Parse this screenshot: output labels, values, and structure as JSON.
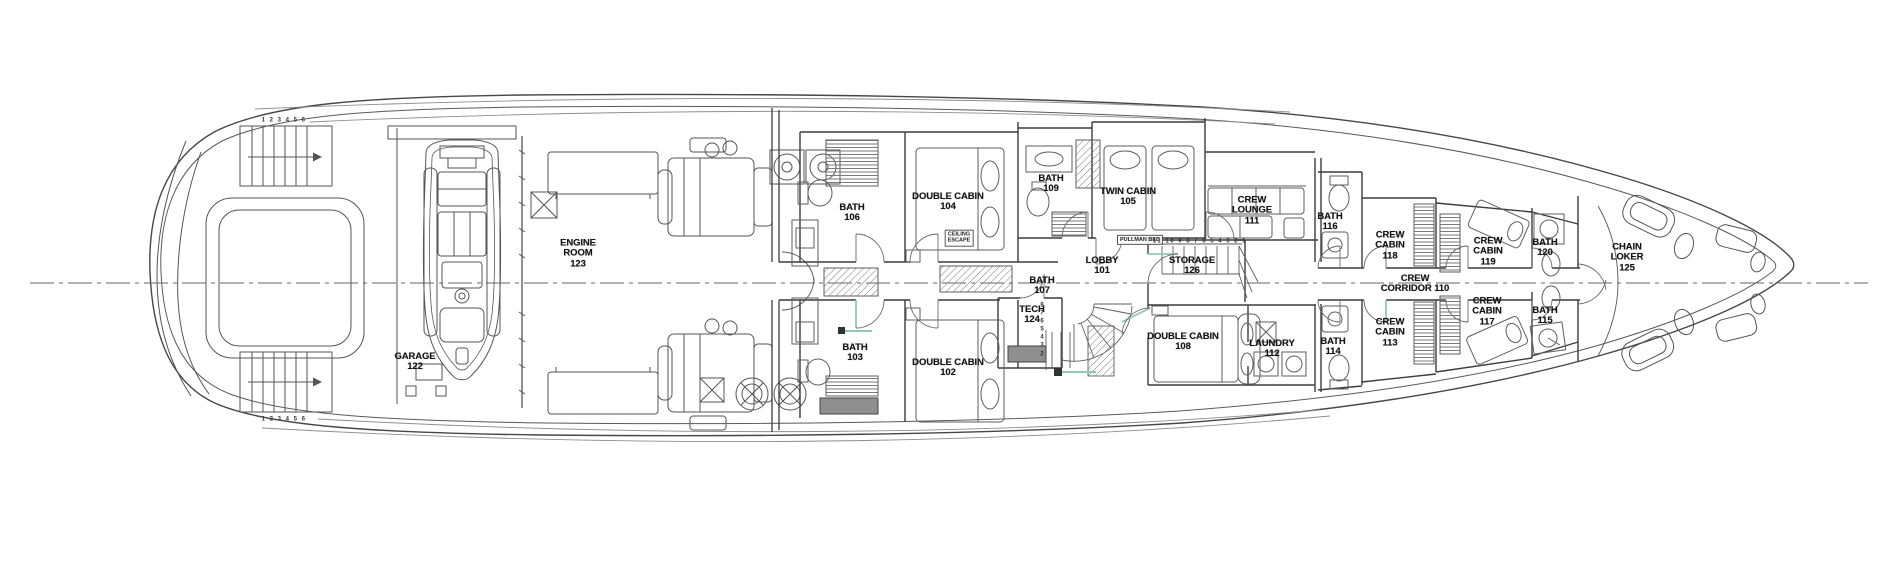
{
  "colors": {
    "paper": "#ffffff",
    "ink": "#4a4a4a",
    "wall_ink": "#3c3c3c",
    "label_ink": "#141414",
    "door_accent": "#8fc9ba",
    "solid_gray": "#8f8f8f"
  },
  "labels": {
    "rooms": [
      {
        "name": "garage",
        "lines": [
          "GARAGE",
          "122"
        ],
        "x": 415,
        "y": 362
      },
      {
        "name": "engine-room",
        "lines": [
          "ENGINE",
          "ROOM",
          "123"
        ],
        "x": 578,
        "y": 254
      },
      {
        "name": "bath-106",
        "lines": [
          "BATH",
          "106"
        ],
        "x": 852,
        "y": 213
      },
      {
        "name": "double-cabin-104",
        "lines": [
          "DOUBLE CABIN",
          "104"
        ],
        "x": 948,
        "y": 202
      },
      {
        "name": "bath-103",
        "lines": [
          "BATH",
          "103"
        ],
        "x": 855,
        "y": 353
      },
      {
        "name": "double-cabin-102",
        "lines": [
          "DOUBLE CABIN",
          "102"
        ],
        "x": 948,
        "y": 368
      },
      {
        "name": "bath-109",
        "lines": [
          "BATH",
          "109"
        ],
        "x": 1051,
        "y": 184
      },
      {
        "name": "twin-cabin-105",
        "lines": [
          "TWIN CABIN",
          "105"
        ],
        "x": 1128,
        "y": 197
      },
      {
        "name": "lobby-101",
        "lines": [
          "LOBBY",
          "101"
        ],
        "x": 1102,
        "y": 266
      },
      {
        "name": "bath-107",
        "lines": [
          "BATH",
          "107"
        ],
        "x": 1042,
        "y": 286
      },
      {
        "name": "tech-124",
        "lines": [
          "TECH",
          "124"
        ],
        "x": 1032,
        "y": 315
      },
      {
        "name": "storage-126",
        "lines": [
          "STORAGE",
          "126"
        ],
        "x": 1192,
        "y": 266
      },
      {
        "name": "crew-lounge-111",
        "lines": [
          "CREW",
          "LOUNGE",
          "111"
        ],
        "x": 1252,
        "y": 211
      },
      {
        "name": "double-cabin-108",
        "lines": [
          "DOUBLE CABIN",
          "108"
        ],
        "x": 1183,
        "y": 342
      },
      {
        "name": "laundry-112",
        "lines": [
          "LAUNDRY",
          "112"
        ],
        "x": 1272,
        "y": 349
      },
      {
        "name": "crew-corridor-110",
        "lines": [
          "CREW",
          "CORRIDOR 110"
        ],
        "x": 1415,
        "y": 284
      },
      {
        "name": "bath-116",
        "lines": [
          "BATH",
          "116"
        ],
        "x": 1330,
        "y": 222
      },
      {
        "name": "crew-cabin-118",
        "lines": [
          "CREW",
          "CABIN",
          "118"
        ],
        "x": 1390,
        "y": 246
      },
      {
        "name": "bath-114",
        "lines": [
          "BATH",
          "114"
        ],
        "x": 1333,
        "y": 347
      },
      {
        "name": "crew-cabin-113",
        "lines": [
          "CREW",
          "CABIN",
          "113"
        ],
        "x": 1390,
        "y": 333
      },
      {
        "name": "crew-cabin-119",
        "lines": [
          "CREW",
          "CABIN",
          "119"
        ],
        "x": 1488,
        "y": 252
      },
      {
        "name": "bath-120",
        "lines": [
          "BATH",
          "120"
        ],
        "x": 1545,
        "y": 248
      },
      {
        "name": "crew-cabin-117",
        "lines": [
          "CREW",
          "CABIN",
          "117"
        ],
        "x": 1487,
        "y": 312
      },
      {
        "name": "bath-115",
        "lines": [
          "BATH",
          "115"
        ],
        "x": 1545,
        "y": 316
      },
      {
        "name": "chain-locker-125",
        "lines": [
          "CHAIN",
          "LOKER",
          "125"
        ],
        "x": 1627,
        "y": 258
      }
    ],
    "tags": [
      {
        "name": "ceiling-escape",
        "lines": [
          "CEILING",
          "ESCAPE"
        ],
        "x": 959,
        "y": 238
      },
      {
        "name": "pullman-bed",
        "lines": [
          "PULLMAN  BED"
        ],
        "x": 1140,
        "y": 240
      }
    ],
    "stair_numbers": [
      {
        "name": "aft-stairs-top",
        "text": "1 2 3 4 5 6",
        "x": 284,
        "y": 121,
        "dir": "h"
      },
      {
        "name": "aft-stairs-bottom",
        "text": "1 2 3 4 5 6",
        "x": 284,
        "y": 420,
        "dir": "h"
      },
      {
        "name": "storage-stairs",
        "text": "11 10 9 8 7 6 5 4 3 2 1",
        "x": 1200,
        "y": 242,
        "dir": "h"
      },
      {
        "name": "lobby-stairs",
        "text": "8 7 6 5 4 3 2",
        "x": 1042,
        "y": 330,
        "dir": "v"
      }
    ]
  }
}
